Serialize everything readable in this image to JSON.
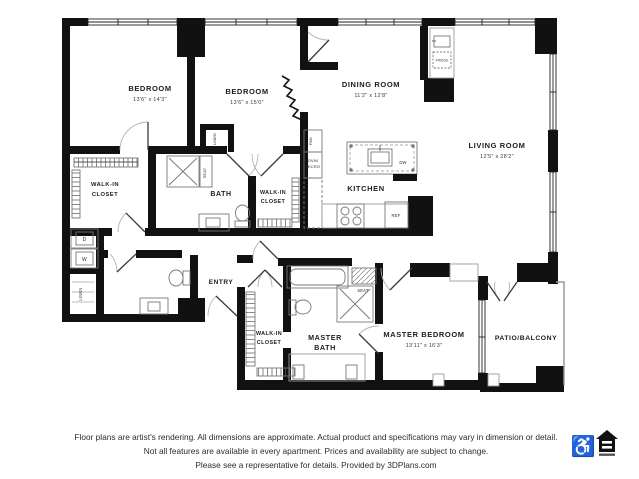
{
  "plan": {
    "rooms": {
      "bedroom1": {
        "name": "BEDROOM",
        "dims": "13'6\" x 14'3\""
      },
      "bedroom2": {
        "name": "BEDROOM",
        "dims": "13'6\" x 15'0\""
      },
      "dining": {
        "name": "DINING ROOM",
        "dims": "11'2\" x 12'8\""
      },
      "living": {
        "name": "LIVING ROOM",
        "dims": "12'5\" x 28'2\""
      },
      "kitchen": {
        "name": "KITCHEN"
      },
      "bath": {
        "name": "BATH"
      },
      "walk_in_closet_1": {
        "line1": "WALK-IN",
        "line2": "CLOSET"
      },
      "walk_in_closet_2": {
        "line1": "WALK-IN",
        "line2": "CLOSET"
      },
      "walk_in_closet_3": {
        "line1": "WALK-IN",
        "line2": "CLOSET"
      },
      "entry": {
        "name": "ENTRY"
      },
      "master_bath": {
        "line1": "MASTER",
        "line2": "BATH"
      },
      "master_bedroom": {
        "name": "MASTER BEDROOM",
        "dims": "13'11\" x 16'3\""
      },
      "patio": {
        "name": "PATIO/BALCONY"
      }
    },
    "fixtures": {
      "linen_upper": "LINEN",
      "linen_lower": "LINEN",
      "pantry": "PAN",
      "oven_line1": "OVN/",
      "oven_line2": "MICRO",
      "dishwasher": "DW",
      "refrigerator": "REF",
      "fridge_small": "FRIDGE",
      "seat_bath": "SEAT",
      "seat_master": "SEAT",
      "washer": "W",
      "dryer": "D"
    }
  },
  "footer": {
    "line1": "Floor plans are artist's rendering. All dimensions are approximate. Actual product and specifications may vary in dimension or detail.",
    "line2": "Not all features are available in every apartment. Prices and availability are subject to change.",
    "line3": "Please see a representative for details. Provided by 3DPlans.com",
    "wheelchair_icon": "♿"
  },
  "colors": {
    "wall": "#111111",
    "thin_line": "#999999",
    "fixture_line": "#777777",
    "text": "#222222"
  }
}
